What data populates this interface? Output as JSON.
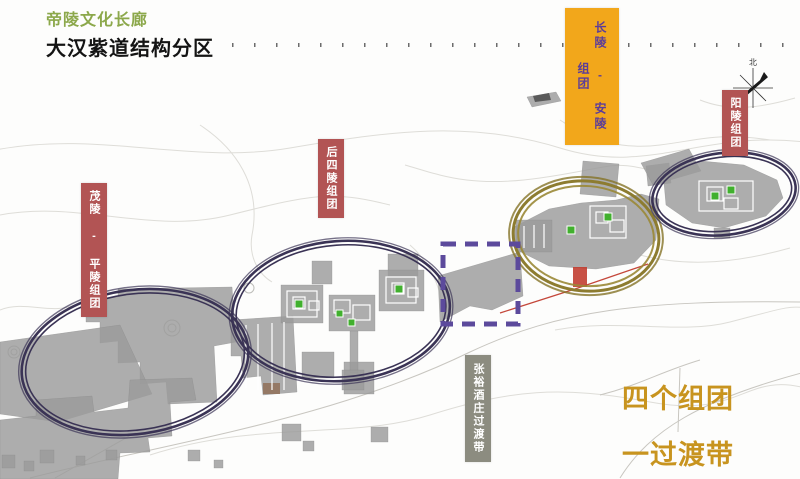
{
  "header": {
    "subtitle": "帝陵文化长廊",
    "title": "大汉紫道结构分区"
  },
  "map": {
    "compass_label": "北",
    "groups": [
      {
        "id": "maoling-pingling",
        "label": "茂陵 - 平陵组团",
        "style": "red-badge"
      },
      {
        "id": "housiling",
        "label": "后四陵组团",
        "style": "red-badge"
      },
      {
        "id": "changling-anling",
        "label": "长陵 - 安陵组团",
        "style": "yellow-badge"
      },
      {
        "id": "yangling",
        "label": "阳陵组团",
        "style": "red-badge"
      },
      {
        "id": "zhangyu-transition",
        "label": "张裕酒庄过渡带",
        "style": "gray-badge"
      }
    ],
    "summary": {
      "line1": "四个组团",
      "line2": "一过渡带"
    },
    "legend_icons": [
      "group-ellipse",
      "transition-dashed-box",
      "tomb-site-marker",
      "north-compass"
    ]
  },
  "colors": {
    "title_green": "#8CA84B",
    "label_red_bg": "#B25454",
    "label_yellow_bg": "#F2A71B",
    "label_yellow_text": "#5C3D99",
    "label_gray_bg": "#8C8C80",
    "summary_gold": "#C8941F",
    "ellipse_navy": "#3A3355",
    "ellipse_olive": "#8D7C30",
    "dashed_purple": "#5C4A9C",
    "site_green": "#41B02E",
    "urban_gray": "#9B9B9B",
    "red_marker": "#C0392B"
  }
}
